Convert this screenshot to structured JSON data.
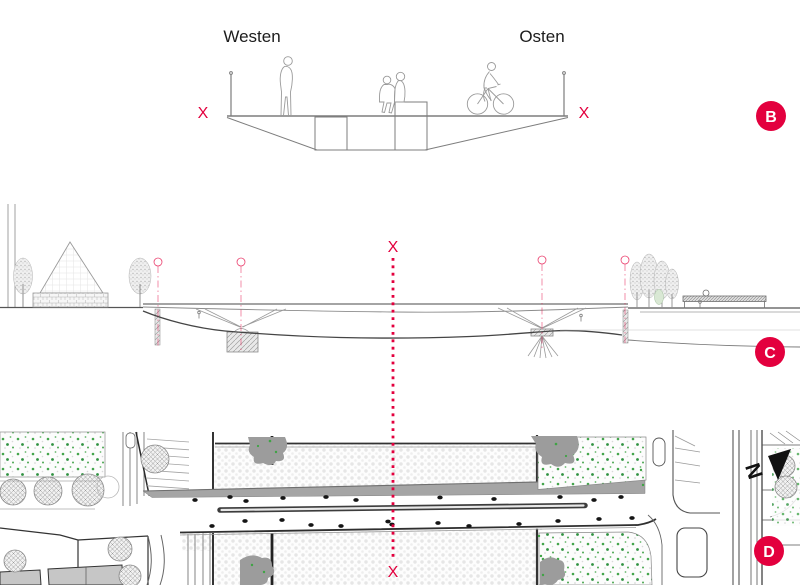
{
  "colors": {
    "accent_red": "#e3003e",
    "ink": "#1c1c1c",
    "line_gray": "#8a8a8a"
  },
  "panel_b": {
    "badge": "B",
    "label_west": "Westen",
    "label_east": "Osten",
    "marker_left": "X",
    "marker_right": "X"
  },
  "panel_c": {
    "badge": "C",
    "marker_top": "X"
  },
  "panel_d": {
    "badge": "D",
    "marker_bottom": "X",
    "north_label": "N"
  }
}
